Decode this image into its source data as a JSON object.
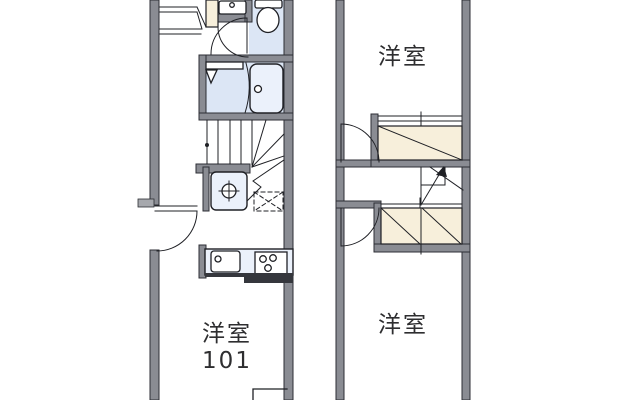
{
  "colors": {
    "background": "#ffffff",
    "wall_fill": "#8a8c93",
    "wall_outline": "#2c2e34",
    "wall_dark": "#35373d",
    "step_fill": "#a6a8ad",
    "line": "#1f2025",
    "fixture_fill": "#dce6f5",
    "fixture_light": "#ebf1fb",
    "closet_fill": "#f7efdb",
    "text": "#2e2e30"
  },
  "plan_1f": {
    "room": {
      "label": "洋室",
      "number": "101"
    },
    "fixture_names": [
      "window-icon",
      "washbasin-icon",
      "toilet-icon",
      "bathtub-icon",
      "shower-room-icon",
      "staircase-icon",
      "washing-machine-pan-icon",
      "refrigerator-space-icon",
      "entrance-door-icon",
      "kitchen-sink-icon",
      "gas-stove-icon"
    ]
  },
  "plan_2f": {
    "room_top": {
      "label": "洋室"
    },
    "room_bottom": {
      "label": "洋室"
    },
    "fixture_names": [
      "closet-icon",
      "closet-icon",
      "staircase-up-arrow-icon",
      "door-icon",
      "door-icon"
    ]
  }
}
